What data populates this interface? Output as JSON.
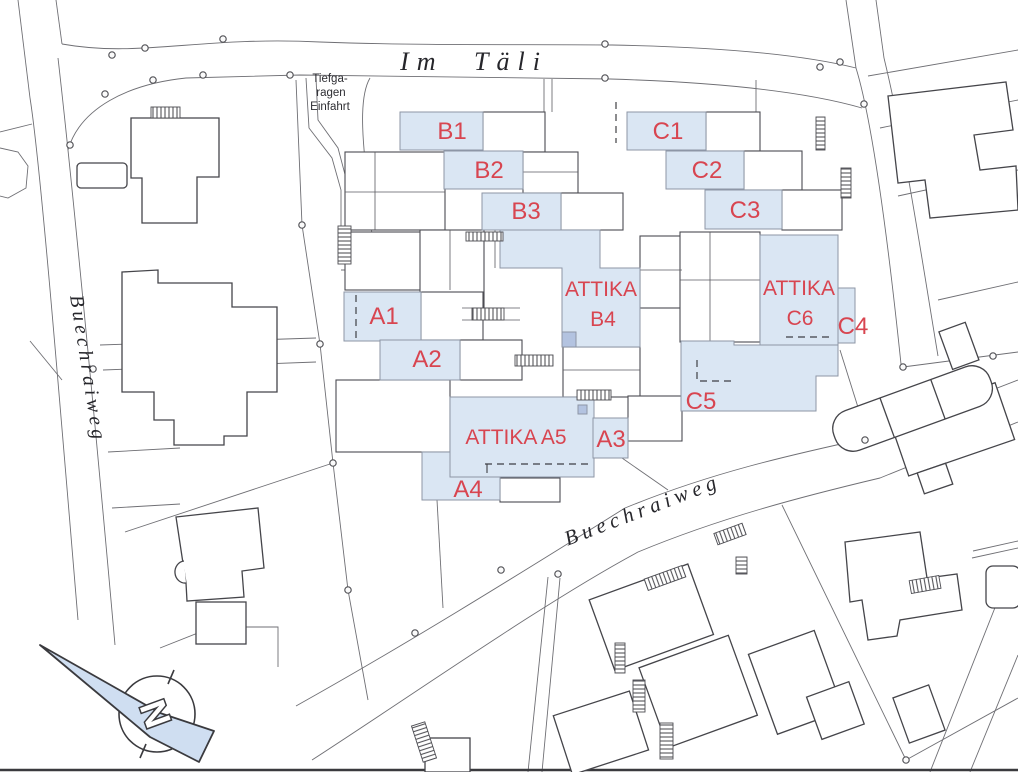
{
  "streets": {
    "im_taeli": "Im Täli",
    "buechraiweg_west": "Buechraiweg",
    "buechraiweg_south": "Buechraiweg"
  },
  "notes": {
    "garage_line1": "Tiefga-",
    "garage_line2": "ragen",
    "garage_line3": "Einfahrt"
  },
  "compass": {
    "north_label": "N"
  },
  "units": {
    "a1": "A1",
    "a2": "A2",
    "a3": "A3",
    "a4": "A4",
    "a5": "ATTIKA A5",
    "b1": "B1",
    "b2": "B2",
    "b3": "B3",
    "b4_line1": "ATTIKA",
    "b4_line2": "B4",
    "c1": "C1",
    "c2": "C2",
    "c3": "C3",
    "c4": "C4",
    "c5": "C5",
    "c6_line1": "ATTIKA",
    "c6_line2": "C6"
  },
  "colors": {
    "unit_fill": "#dae6f3",
    "unit_fill_dark": "#b3c3e0",
    "unit_label": "#d8ororum4550",
    "unit_label_red": "#d84550",
    "compass_fill": "#cfdef1",
    "outline_dark": "#45454a",
    "outline_light": "#6f6f74"
  }
}
